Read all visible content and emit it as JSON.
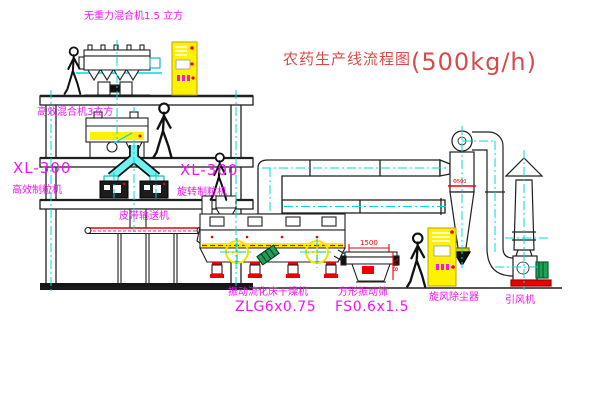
{
  "title": {
    "text_cn": "农药生产线流程图",
    "capacity": "(500kg/h)"
  },
  "equipment_labels": {
    "top_mixer": "无重力混合机1.5 立方",
    "floor_mixer": "高效混合机3立方",
    "left_granulator": {
      "model": "XL-300",
      "name": "高效制粒机"
    },
    "right_granulator": {
      "model": "XL-300",
      "name": "旋转制粒机"
    },
    "belt_conveyor": "皮带输送机",
    "fluid_bed_dryer": {
      "name": "振动流化床干燥机",
      "model": "ZLG6x0.75"
    },
    "vibrating_sieve": {
      "name": "方形振动筛",
      "model": "FS0.6x1.5"
    },
    "cyclone": "旋风除尘器",
    "induced_fan": "引风机"
  },
  "dimensions": {
    "sieve_length": "1500",
    "sieve_height": "548",
    "cyclone_band": "Φ500"
  },
  "colors": {
    "label_magenta": "#f015f0",
    "title_red": "#d84a4a",
    "centerline_cyan": "#00d8d8",
    "equipment_yellow": "#fff200",
    "detail_red": "#ee0000",
    "line_dark": "#1f1f1f"
  }
}
